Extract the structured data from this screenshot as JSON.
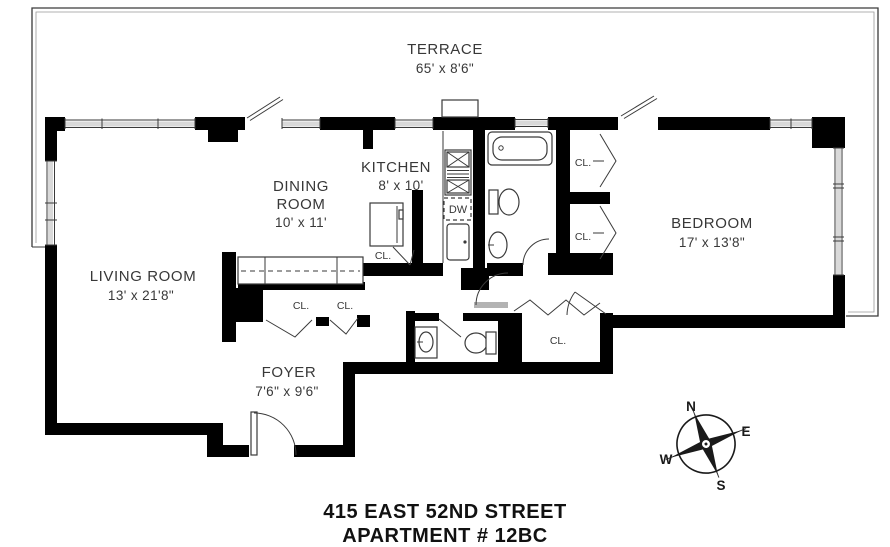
{
  "address": {
    "line1": "415 EAST 52ND STREET",
    "line2": "APARTMENT # 12BC"
  },
  "rooms": {
    "terrace": {
      "name": "TERRACE",
      "dims": "65' x 8'6\""
    },
    "living_room": {
      "name": "LIVING ROOM",
      "dims": "13' x 21'8\""
    },
    "dining_room": {
      "name_line1": "DINING",
      "name_line2": "ROOM",
      "dims": "10' x 11'"
    },
    "kitchen": {
      "name": "KITCHEN",
      "dims": "8' x 10'"
    },
    "bedroom": {
      "name": "BEDROOM",
      "dims": "17' x 13'8\""
    },
    "foyer": {
      "name": "FOYER",
      "dims": "7'6\" x 9'6\""
    }
  },
  "closets": [
    {
      "id": "dining-closet",
      "label": "CL."
    },
    {
      "id": "foyer-closet-left",
      "label": "CL."
    },
    {
      "id": "foyer-closet-right",
      "label": "CL."
    },
    {
      "id": "bedroom-closet-upper",
      "label": "CL."
    },
    {
      "id": "bedroom-closet-lower",
      "label": "CL."
    },
    {
      "id": "hall-closet",
      "label": "CL."
    }
  ],
  "labels": {
    "dishwasher": "DW"
  },
  "compass": {
    "north": "N",
    "east": "E",
    "south": "S",
    "west": "W"
  },
  "colors": {
    "background": "#ffffff",
    "wall": "#000000",
    "line": "#3a3a3a",
    "text": "#383838",
    "window_fill": "#d9d9d9",
    "door_leaf_gray": "#b3b3b3"
  }
}
